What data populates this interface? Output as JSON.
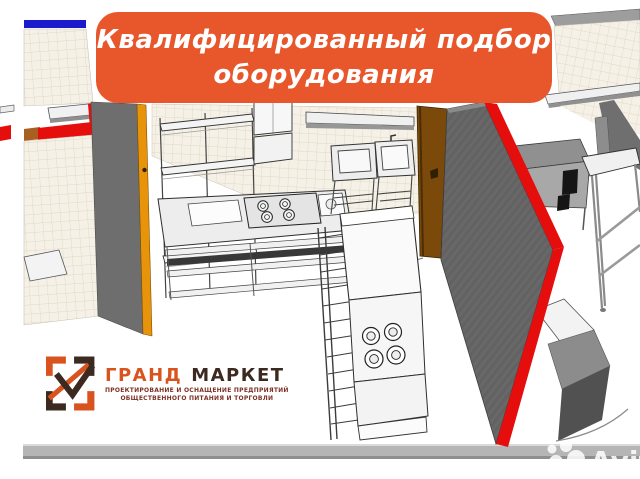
{
  "banner": {
    "line1": "Квалифицированный подбор",
    "line2": "оборудования"
  },
  "logo": {
    "title_part1": "ГРАНД",
    "title_part2": "МАРКЕТ",
    "subtitle_line1": "ПРОЕКТИРОВАНИЕ И ОСНАЩЕНИЕ ПРЕДПРИЯТИЙ",
    "subtitle_line2": "ОБЩЕСТВЕННОГО ПИТАНИЯ И ТОРГОВЛИ"
  },
  "watermark": {
    "label": "Avito"
  },
  "scene": {
    "description": "3D CAD rendering of a commercial kitchen layout: tiled walls with red top edges, gray partition walls, wooden door with orange frame, stainless shelving racks, gas stove island, fryer block with round burners, two sinks on stands, refrigerated counter with black grills and work tables"
  },
  "colors": {
    "banner-bg": "#E8572B",
    "banner-text": "#FFFFFF",
    "logo-orange": "#D9531E",
    "logo-dark": "#3C2A21",
    "logo-subtitle": "#7D3024",
    "wall-red": "#E60D0D",
    "wall-gray": "#6E6E6E",
    "tile-bg": "#F6F1E7",
    "tile-line": "#D9D1C0",
    "door-brown": "#7B4A0A",
    "door-orange": "#E8940A",
    "floor-bar": "#B5B5B5",
    "blue-strip": "#1A1ACC",
    "line-art": "#2E2E2E"
  }
}
